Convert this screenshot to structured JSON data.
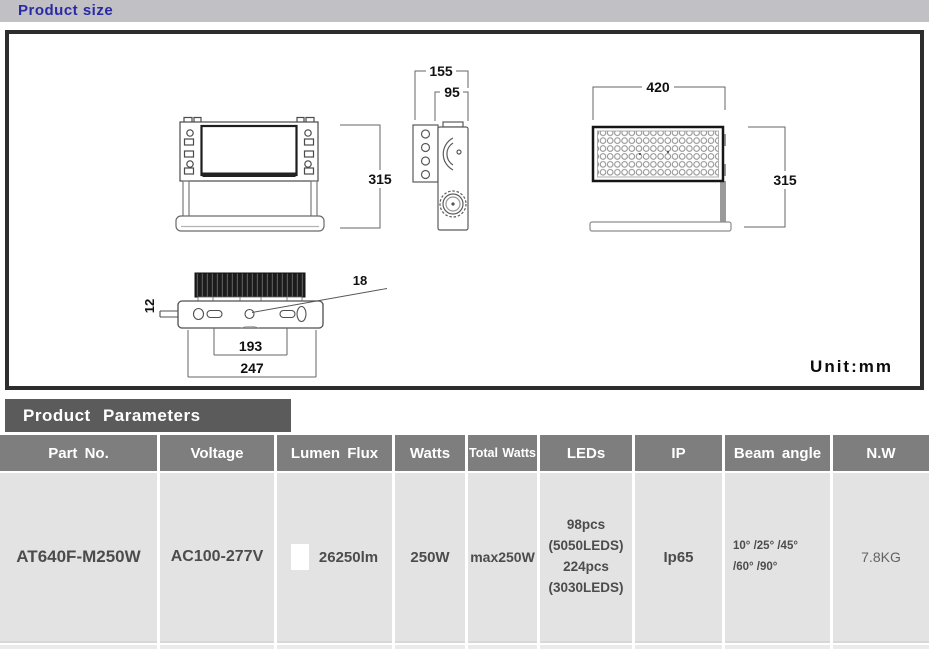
{
  "title_bar": {
    "label": "Product size"
  },
  "diagram": {
    "unit_label": "Unit:mm",
    "dims": {
      "front_height": "315",
      "side_overall_width": "155",
      "side_body_width": "95",
      "panel_width": "420",
      "panel_height": "315",
      "pin_diameter": "12",
      "hole_diameter": "18",
      "slot_spacing": "193",
      "base_length": "247"
    }
  },
  "parameters": {
    "section_title": "Product Parameters",
    "columns": [
      "Part No.",
      "Voltage",
      "Lumen Flux",
      "Watts",
      "Total Watts",
      "LEDs",
      "IP",
      "Beam angle",
      "N.W"
    ],
    "row": {
      "part_no": "AT640F-M250W",
      "voltage": "AC100-277V",
      "lumen_flux": "26250lm",
      "swatch_color": "#ffffff",
      "watts": "250W",
      "total_watts": "max250W",
      "leds_lines": [
        "98pcs",
        "(5050LEDS)",
        "224pcs",
        "(3030LEDS)"
      ],
      "ip": "Ip65",
      "beam_angle_lines": [
        "10° /25° /45°",
        "/60° /90°"
      ],
      "net_weight": "7.8KG"
    }
  },
  "colors": {
    "title_text_blue": "#2a2aa3",
    "titlebar_bg": "#c0c0c5",
    "section_bar_bg": "#5b5b5b",
    "table_header_bg": "#7e7e7e",
    "table_cell_bg": "#e3e3e3",
    "box_border": "#2d2d2d"
  }
}
